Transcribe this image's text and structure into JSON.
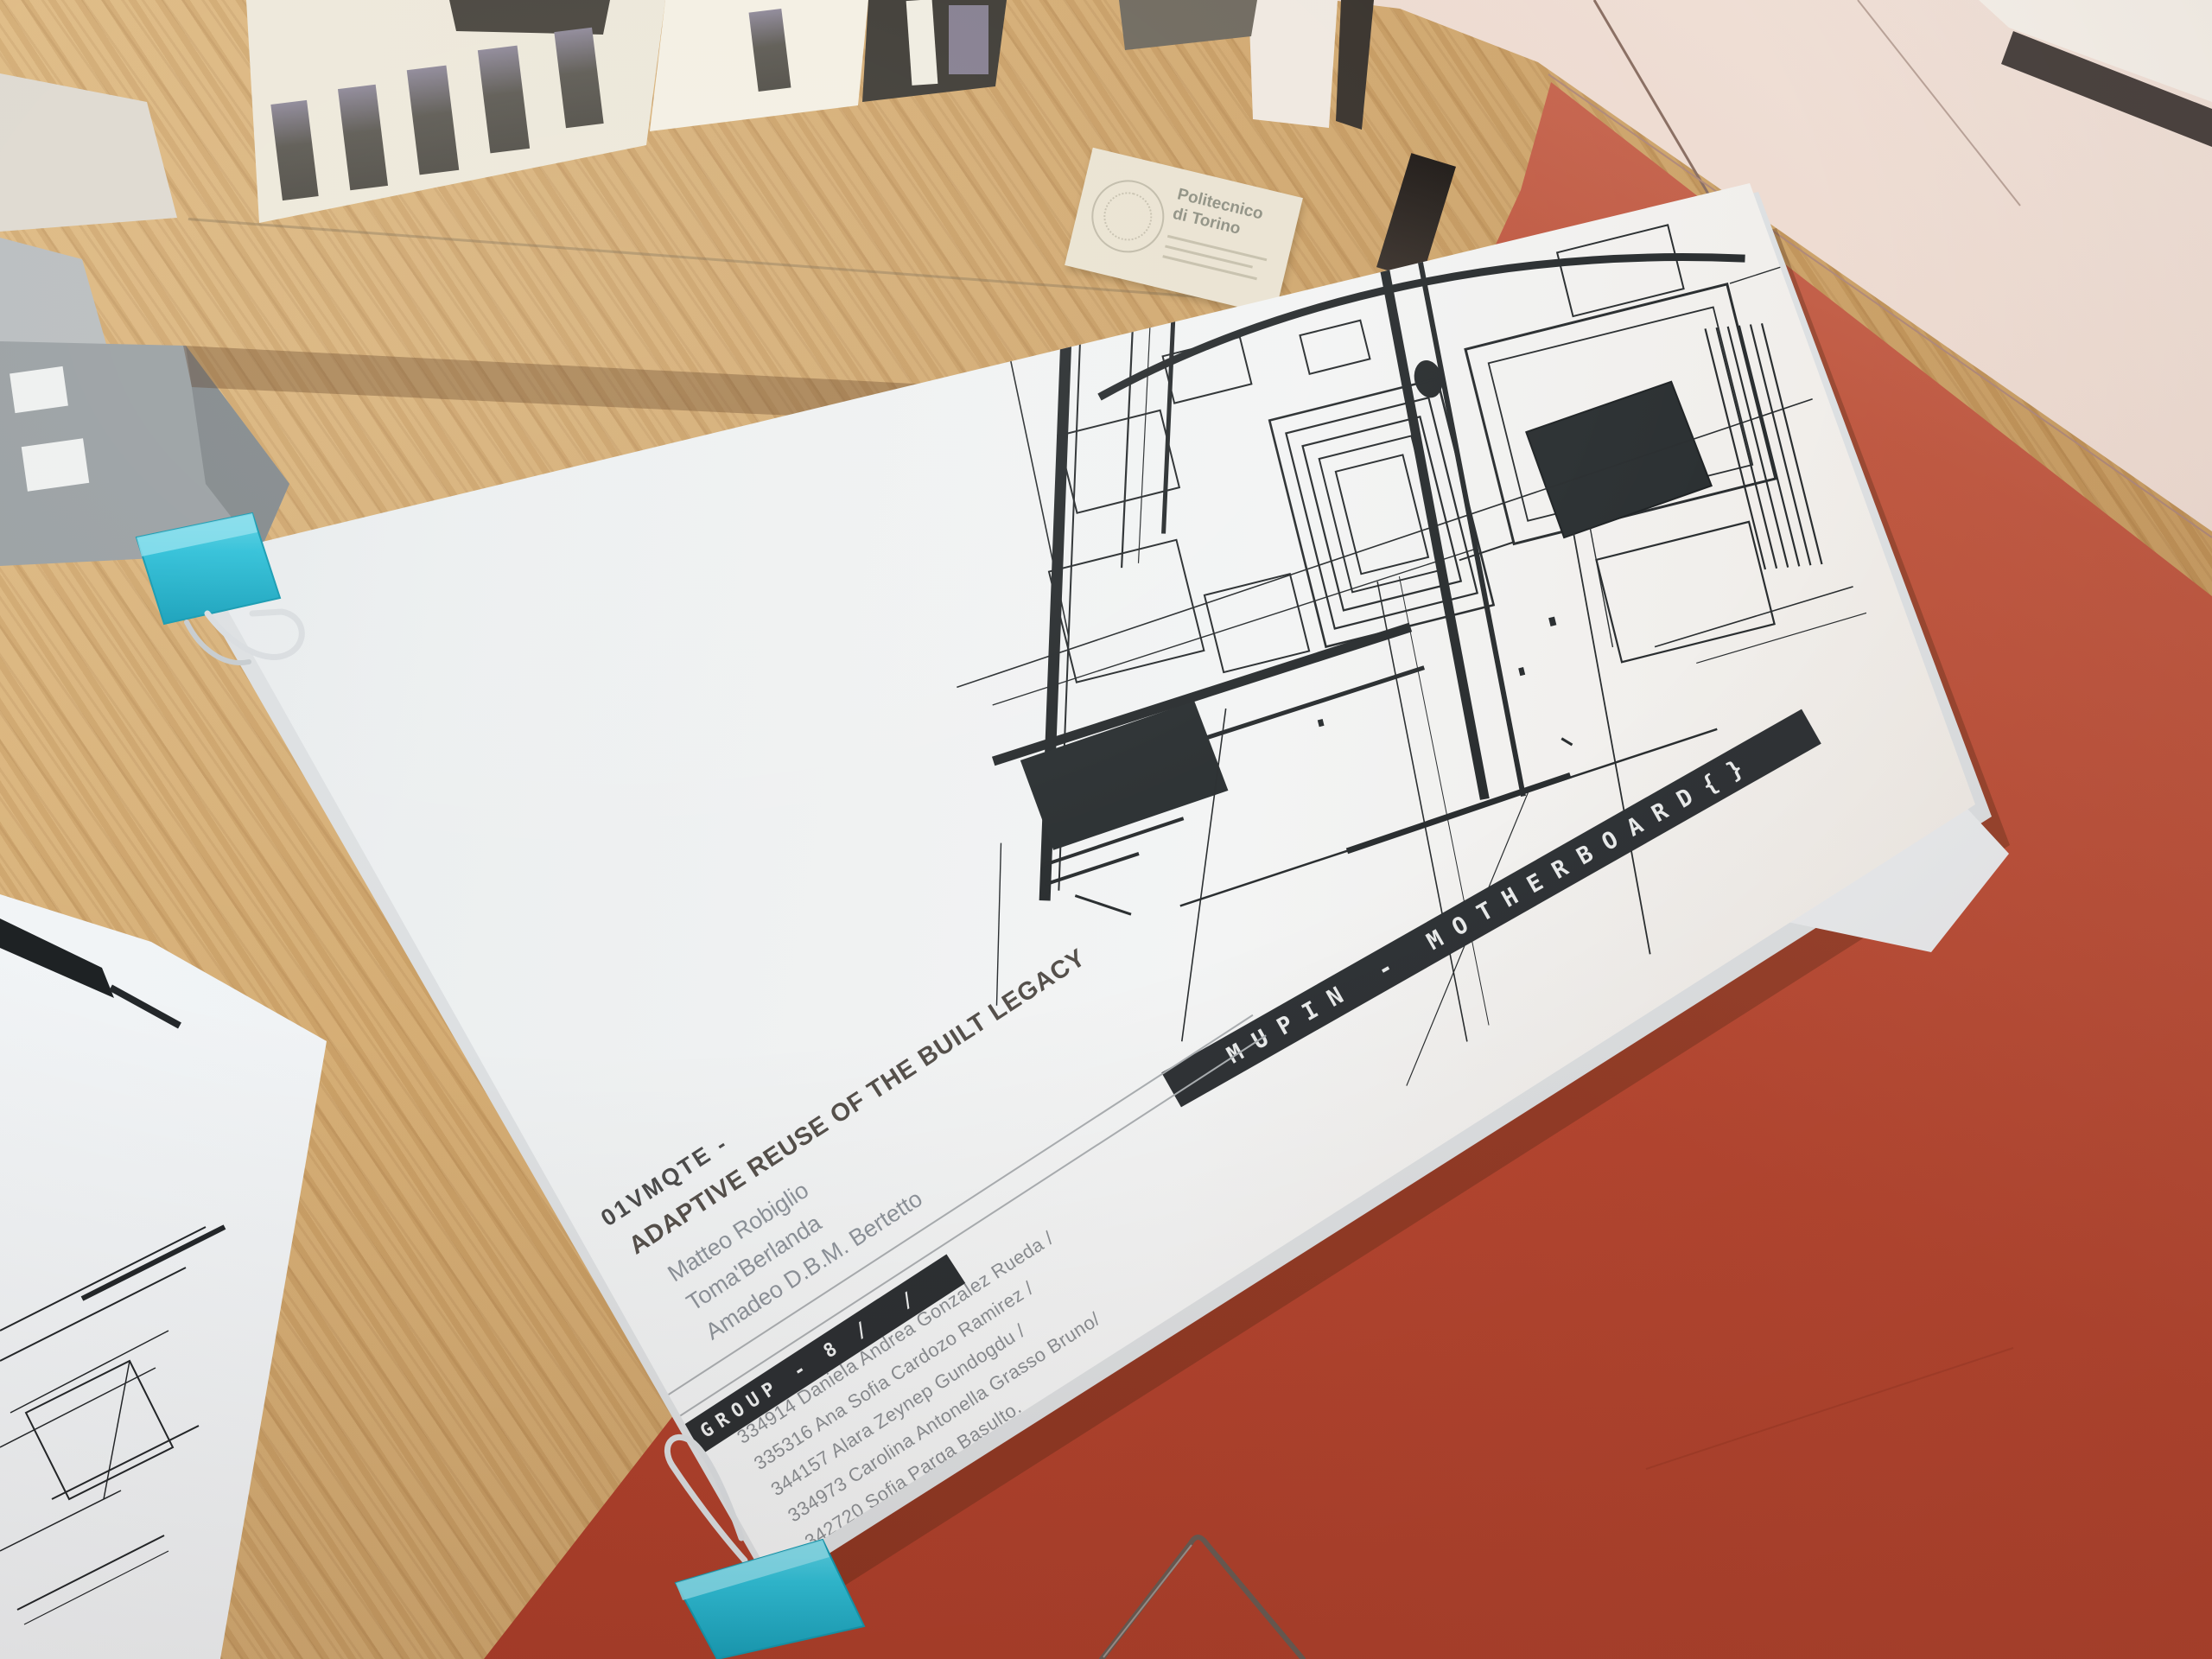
{
  "photo": {
    "description": "Architecture studio title sheet clipped with teal binder clips on a wooden desk next to a red surface, cardboard model above",
    "model_label": {
      "line1": "Politecnico",
      "line2": "di Torino"
    },
    "sheet": {
      "course_code": "01VMQTE -",
      "course_title": "ADAPTIVE REUSE OF THE BUILT LEGACY",
      "professors": [
        "Matteo Robiglio",
        "Toma'Berlanda",
        "Amadeo D.B.M. Bertetto"
      ],
      "group_label": "GROUP - 8 /  /",
      "students": [
        "334914 Daniela Andrea Gonzalez Rueda /",
        "335316 Ana Sofia Cardozo Ramirez /",
        "344157 Alara Zeynep Gundogdu /",
        "334973 Carolina Antonella Grasso Bruno/",
        "342720 Sofia Parga Basulto."
      ],
      "edge_banner": "MUPIN - MOTHERBOARD{}"
    },
    "colors": {
      "desk_wood": "#cda26b",
      "desk_red": "#b4452f",
      "clip_teal": "#2fc0d8",
      "paper": "#eef0f1",
      "ink": "#2a2e30",
      "cabinet": "#e8d2c7"
    }
  }
}
